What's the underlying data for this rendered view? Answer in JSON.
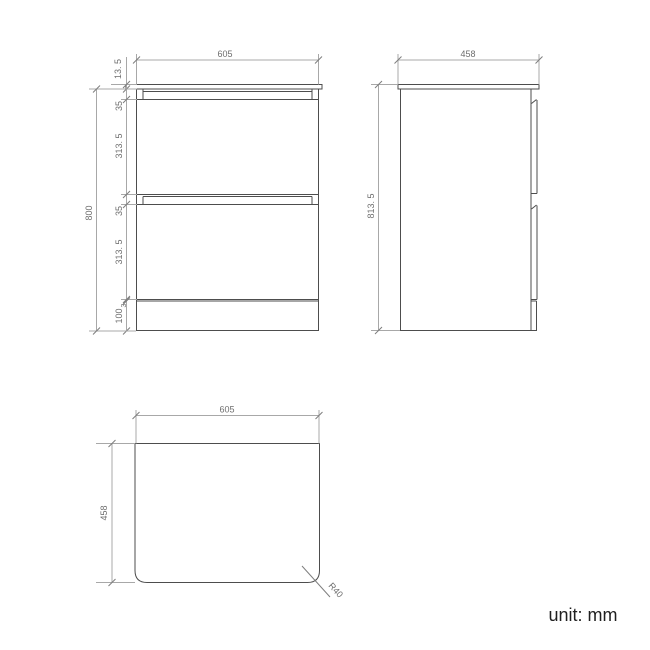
{
  "unit_label": "unit: mm",
  "front_view": {
    "width": "605",
    "countertop_thickness": "13. 5",
    "top_recess": "35",
    "drawer1_height": "313. 5",
    "mid_recess": "35",
    "drawer2_height": "313. 5",
    "gap": "3",
    "plinth_height": "100",
    "body_height": "800"
  },
  "side_view": {
    "depth": "458",
    "total_height": "813. 5"
  },
  "top_view": {
    "width": "605",
    "depth": "458",
    "corner_radius": "R40"
  },
  "colors": {
    "background": "#ffffff",
    "object_line": "#4d4d4d",
    "dimension_line": "#a8a8a8",
    "dimension_text": "#6e6e6e",
    "unit_text": "#1f1f1f"
  }
}
